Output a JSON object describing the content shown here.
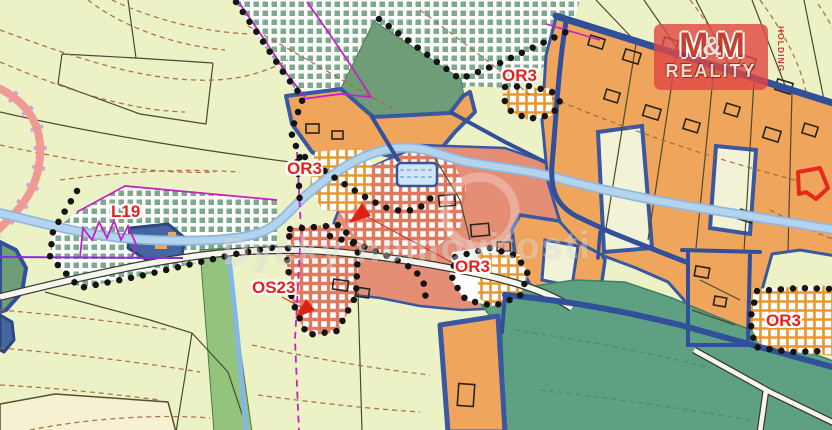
{
  "map": {
    "labels": [
      {
        "id": "L19",
        "text": "L19"
      },
      {
        "id": "OR3-north",
        "text": "OR3"
      },
      {
        "id": "OR3-west",
        "text": "OR3"
      },
      {
        "id": "OR3-central",
        "text": "OR3"
      },
      {
        "id": "OR3-southeast",
        "text": "OR3"
      },
      {
        "id": "OS23",
        "text": "OS23"
      }
    ],
    "watermark": {
      "text": "Dycky nemovitosti"
    },
    "logo": {
      "m_left": "M",
      "ampersand": "&",
      "m_right": "M",
      "wordmark": "REALITY",
      "holding": "HOLDING"
    },
    "colors": {
      "background": "#edf1c6",
      "zone_orange": "#f0a55c",
      "zone_salmon": "#e58e76",
      "zone_green_solid": "#6f9d77",
      "zone_green_meadow": "#5da182",
      "hatch_green": "#7fa98d",
      "hatch_orange": "#e8962e",
      "hatch_salmon": "#e07a5f",
      "river_blue": "#a9cdeb",
      "road_navy": "#32509a",
      "boundary_magenta": "#c224c2",
      "label_red": "#e8201a",
      "logo_red": "#df4842"
    }
  }
}
